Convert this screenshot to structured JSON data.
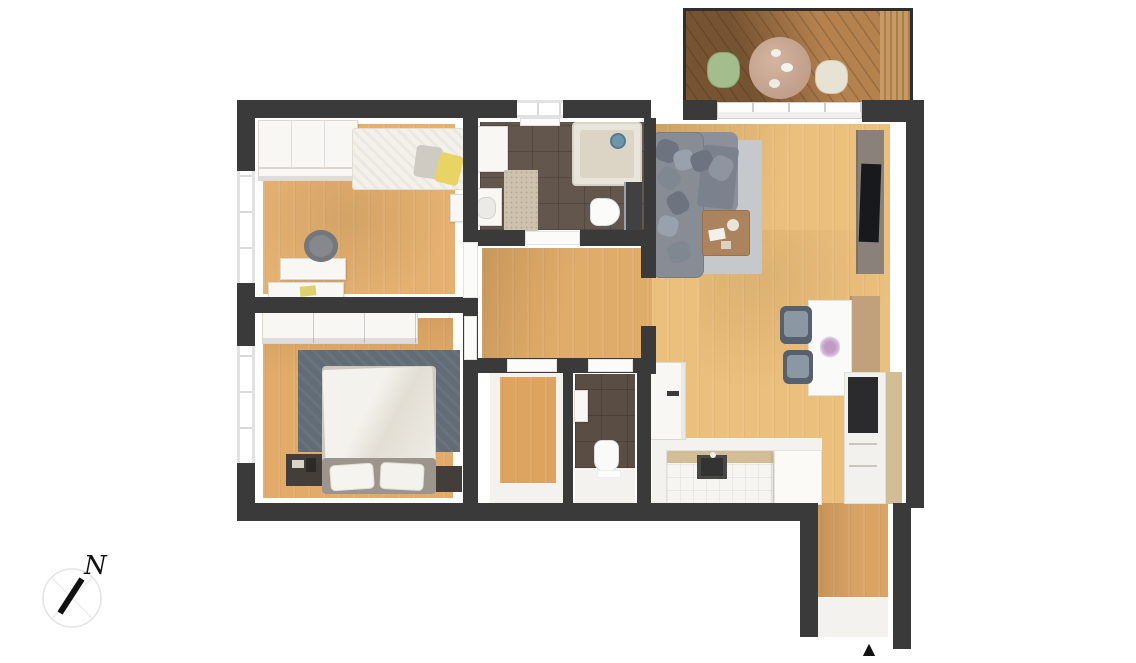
{
  "compass": {
    "label": "N"
  },
  "icons": {
    "entrance_glyph": "▲"
  },
  "palette": {
    "wall": "#3a3a3a",
    "wood_bed": "#e4b171",
    "wood_hall": "#e0ac6a",
    "wood_living": "#ebbf7c",
    "wood_master": "#e2ab69",
    "wood_storage": "#dda45f",
    "wood_corridor": "#d9a364",
    "deck": "#b5824e",
    "tile_bath": "#63564c",
    "tile_wc": "#594d44",
    "floor_white": "#f4f2ee",
    "furn_white": "#f8f7f4",
    "sofa_grey": "#878c95",
    "rug_living": "#c6c9cc",
    "rug_master": "#616c76",
    "pillow_yellow": "#e8d463",
    "chair_green": "#a3bd8c",
    "chair_cream": "#e6e2d4",
    "shower_blue": "#6e95a9",
    "chair_dining": "#57616d",
    "table_wood": "#ab835c",
    "bench_wood": "#c0a17c",
    "kitchen_wood": "#d3bd96",
    "tv_black": "#17191d",
    "marker_black": "#111111"
  }
}
